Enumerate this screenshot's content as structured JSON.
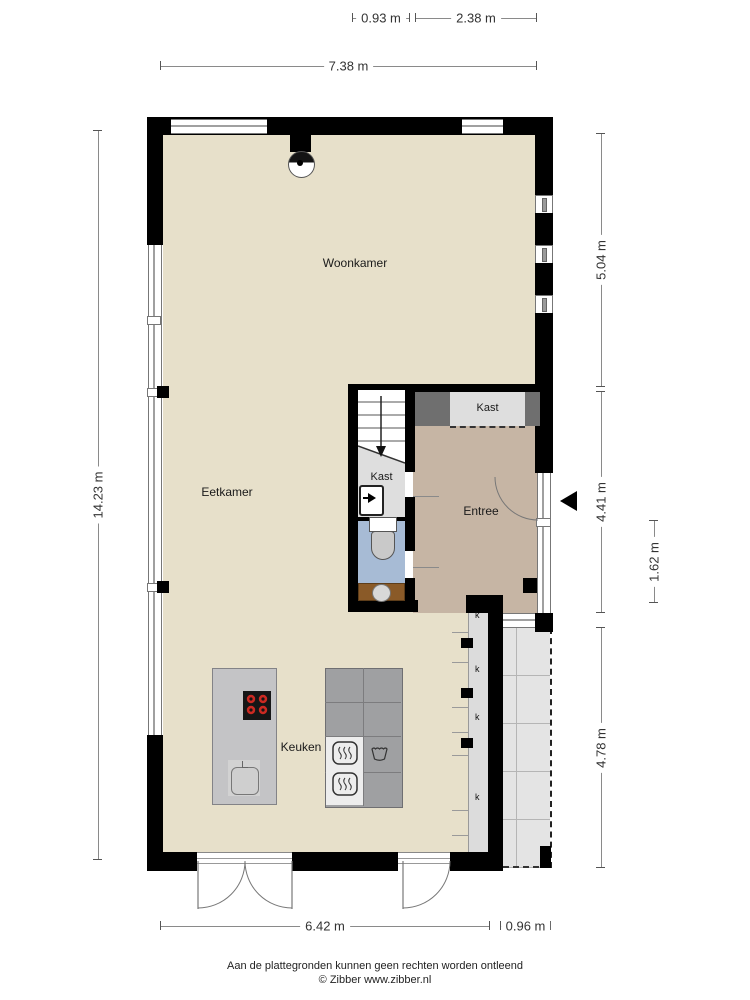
{
  "rooms": {
    "woonkamer": "Woonkamer",
    "eetkamer": "Eetkamer",
    "keuken": "Keuken",
    "entree": "Entree",
    "kast_upper": "Kast",
    "kast_meter": "Kast"
  },
  "dimensions": {
    "top_small_left": "0.93 m",
    "top_small_right": "2.38 m",
    "top_total": "7.38 m",
    "left_total": "14.23 m",
    "right_upper": "5.04 m",
    "right_middle": "4.41 m",
    "right_inner": "1.62 m",
    "right_lower": "4.78 m",
    "bottom_main": "6.42 m",
    "bottom_right": "0.96 m"
  },
  "markers": {
    "k1": "k",
    "k2": "k",
    "k3": "k",
    "k4": "k"
  },
  "footer": {
    "line1": "Aan de plattegronden kunnen geen rechten worden ontleend",
    "line2": "© Zibber www.zibber.nl"
  },
  "colors": {
    "wall": "#000000",
    "main_floor": "#e7e0ca",
    "entree_floor": "#c6b5a4",
    "closet_floor": "#dedede",
    "wc_floor": "#a7bbd5",
    "vanity": "#8a5a28",
    "burner_red": "#cc2a22",
    "terrace": "#e4e4e4"
  }
}
